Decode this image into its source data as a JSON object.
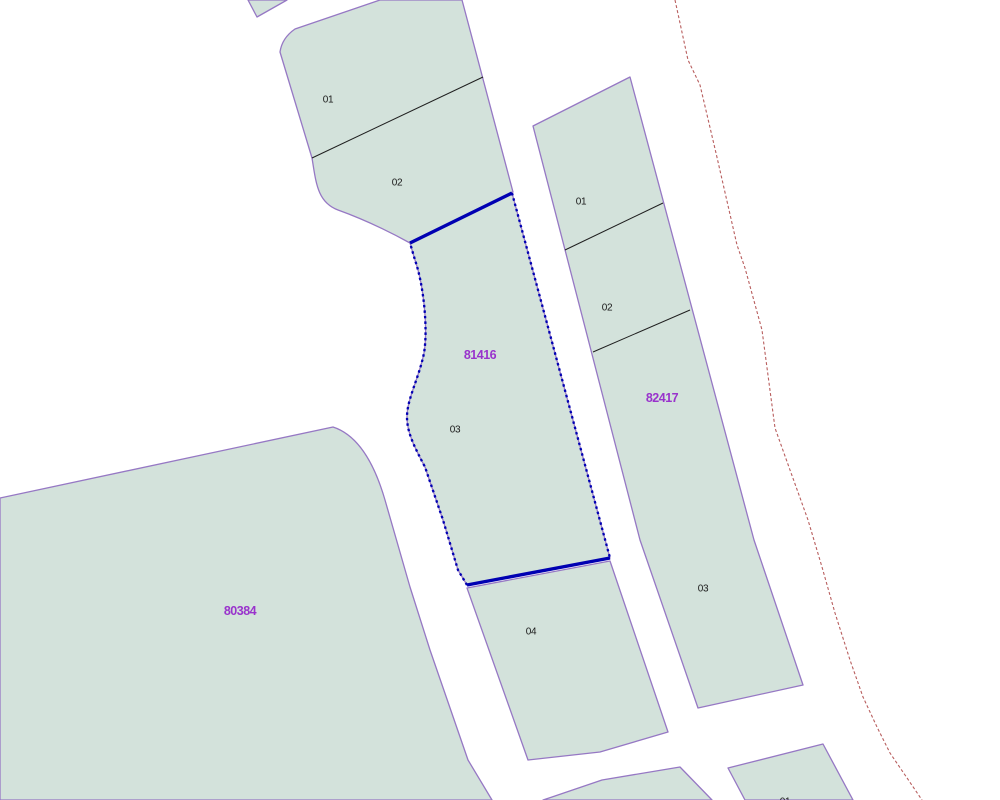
{
  "map": {
    "colors": {
      "background": "#ffffff",
      "parcel_fill": "#d3e2db",
      "parcel_border": "#9678c4",
      "selection_blue": "#0000b2",
      "subdivision_line": "#1f1f1f",
      "boundary_red": "#b85e5e",
      "parcel_number_purple": "#9933cc",
      "sub_label_black": "#1a1a1a"
    },
    "parcels": [
      {
        "name": "parcel-fragment-top",
        "path": "M248,0 L287,0 L257,17 Z"
      },
      {
        "name": "parcel-north-block",
        "path": "M380,0 L462,0 L513,192 L410,243 C390,232 363,219 338,210 C317,202 316,182 312,158 L280,52 Q282,38 295,29 Z"
      },
      {
        "name": "parcel-81416",
        "path": "M410,243 L512,193 L610,558 L467,585 L458,570 L443,520 L425,467 C415,448 407,433 407,417 C407,399 419,378 424,353 C428,330 424,286 415,260 Z"
      },
      {
        "name": "parcel-04",
        "path": "M467,588 L610,561 L668,732 L600,752 L528,760 Z"
      },
      {
        "name": "parcel-80384",
        "path": "M0,498 L333,427 Q367,438 385,500 L410,587 L430,650 L468,760 L492,800 L0,800 Z"
      },
      {
        "name": "parcel-82417",
        "path": "M630,77 L754,540 L803,685 L698,708 L640,540 L533,126 Z"
      },
      {
        "name": "parcel-bottom-left",
        "path": "M543,800 L552,797 L602,780 L680,767 L712,800 Z"
      },
      {
        "name": "parcel-bottom-right",
        "path": "M745,800 L728,768 L823,744 L853,800 Z"
      }
    ],
    "subdivision_lines": [
      {
        "name": "divider-north-01-02",
        "path": "M312,158 L483,77"
      },
      {
        "name": "divider-east-01-02",
        "path": "M565,250 L663,203"
      },
      {
        "name": "divider-east-02-03",
        "path": "M593,352 L690,310"
      }
    ],
    "selection": {
      "parcel": "81416",
      "solid_edges": [
        {
          "name": "selection-edge-top",
          "path": "M410,243 L512,193"
        },
        {
          "name": "selection-edge-bottom",
          "path": "M467,585 L610,558"
        }
      ],
      "dashed_edges": [
        {
          "name": "selection-edge-right",
          "path": "M512,193 L610,558"
        },
        {
          "name": "selection-edge-left",
          "path": "M467,585 L458,570 L443,520 L425,467 C415,448 407,433 407,417 C407,399 419,378 424,353 C428,330 424,286 415,260 L410,243"
        }
      ]
    },
    "red_boundary": {
      "name": "boundary-line-red",
      "path": "M675,0 L688,60 L700,85 L716,153 L737,245 L745,268 L762,330 L775,428 L790,470 L808,520 L822,567 L835,613 L850,660 L863,697 L877,727 L890,753 L905,775 L922,800"
    },
    "labels": [
      {
        "text": "01",
        "x": 328,
        "y": 100,
        "kind": "sub"
      },
      {
        "text": "02",
        "x": 397,
        "y": 183,
        "kind": "sub"
      },
      {
        "text": "81416",
        "x": 480,
        "y": 355,
        "kind": "num"
      },
      {
        "text": "03",
        "x": 455,
        "y": 430,
        "kind": "sub"
      },
      {
        "text": "04",
        "x": 531,
        "y": 632,
        "kind": "sub"
      },
      {
        "text": "80384",
        "x": 240,
        "y": 611,
        "kind": "num"
      },
      {
        "text": "01",
        "x": 581,
        "y": 202,
        "kind": "sub"
      },
      {
        "text": "02",
        "x": 607,
        "y": 308,
        "kind": "sub"
      },
      {
        "text": "82417",
        "x": 662,
        "y": 398,
        "kind": "num"
      },
      {
        "text": "03",
        "x": 703,
        "y": 589,
        "kind": "sub"
      },
      {
        "text": "01",
        "x": 785,
        "y": 802,
        "kind": "sub"
      }
    ]
  }
}
